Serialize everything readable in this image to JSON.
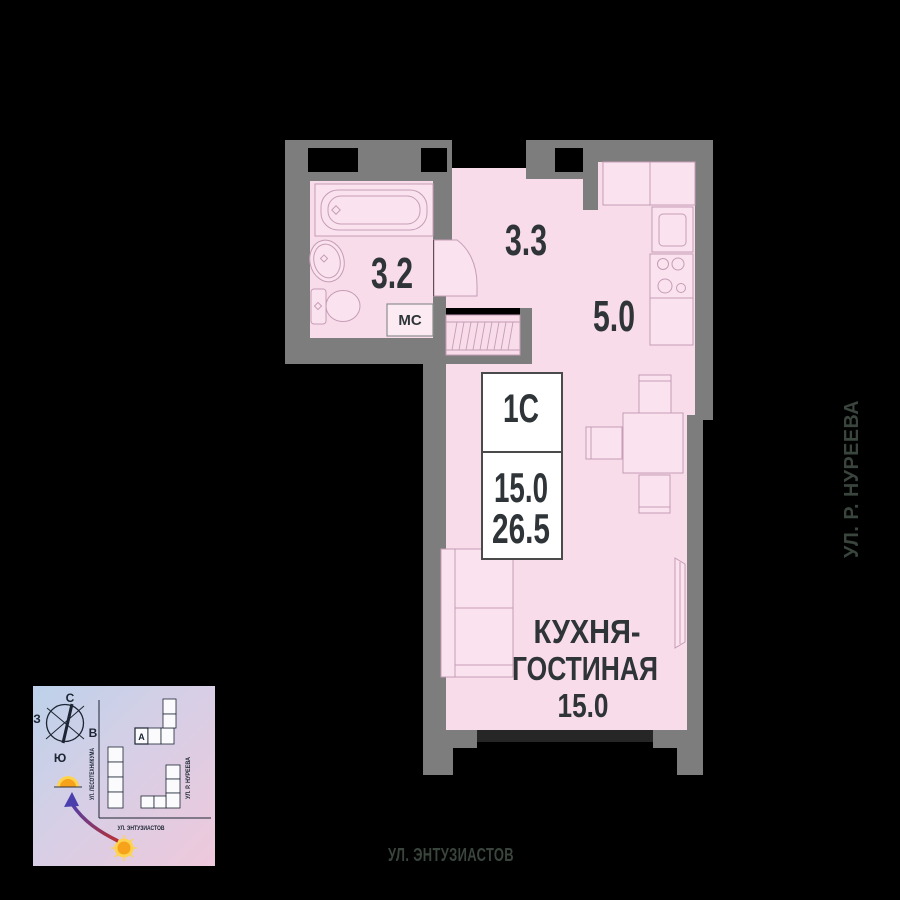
{
  "plan": {
    "info_box": {
      "type": "1С",
      "living_area": "15.0",
      "total_area": "26.5"
    },
    "rooms": {
      "bathroom_area": "3.2",
      "hallway_area": "3.3",
      "kitchen_area": "5.0",
      "living_name_line1": "КУХНЯ-",
      "living_name_line2": "ГОСТИНАЯ",
      "living_area": "15.0",
      "washing_machine_label": "МС"
    }
  },
  "streets": {
    "right_vertical": "УЛ. Р. НУРЕЕВА",
    "bottom": "УЛ. ЭНТУЗИАСТОВ"
  },
  "minimap": {
    "compass": {
      "north": "С",
      "south": "Ю",
      "west": "З",
      "east": "В"
    },
    "building_label": "А",
    "streets": {
      "left_vertical": "УЛ. ЛЕСОТЕХНИКУМА",
      "right_vertical": "УЛ. Р. НУРЕЕВА",
      "bottom": "УЛ. ЭНТУЗИАСТОВ"
    }
  },
  "colors": {
    "background": "#000000",
    "wall": "#7d7d7d",
    "floor": "#f8dcea",
    "fixture_fill": "#fbe2ef",
    "fixture_stroke": "#c59db6",
    "label_text": "#2e3437",
    "street_text": "#3a453e",
    "info_border": "#4a4a4a",
    "minimap_ink": "#1c2533",
    "sun_orange": "#f6a21a",
    "sun_yellow": "#ffd34d"
  }
}
